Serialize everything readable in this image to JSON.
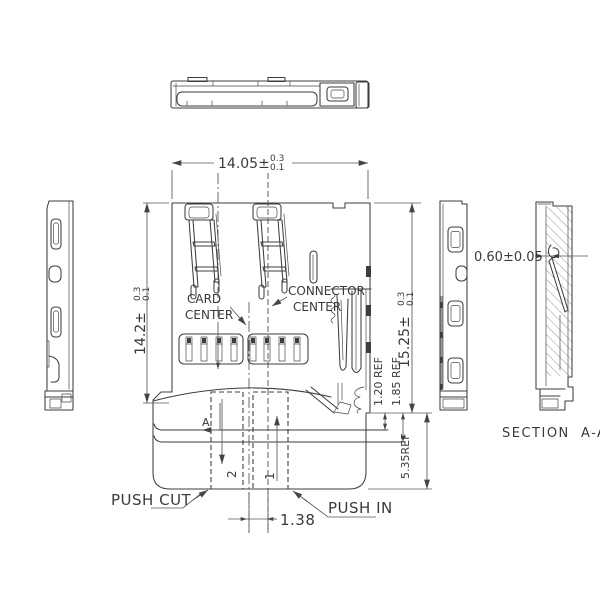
{
  "colors": {
    "background": "#ffffff",
    "object_line": "#3d3d3d",
    "dimension_line": "#565656",
    "text": "#3a3a3a",
    "shading": "#9b9b9b"
  },
  "dimensions": {
    "top_width": {
      "main": "14.05±",
      "tol_top": "0.3",
      "tol_bot": "0.1"
    },
    "left_height": {
      "main": "14.2±",
      "tol_top": "0.3",
      "tol_bot": "0.1"
    },
    "right_height": {
      "main": "15.25±",
      "tol_top": "0.3",
      "tol_bot": "0.1"
    },
    "shell_thickness": "0.60±0.05",
    "ref_1_20": "1.20 REF",
    "ref_1_85": "1.85 REF",
    "ref_5_35": "5.35REF",
    "center_offset": "1.38"
  },
  "labels": {
    "card_center": [
      "CARD",
      "CENTER"
    ],
    "connector_center": [
      "CONNECTOR",
      "CENTER"
    ],
    "push_cut": "PUSH CUT",
    "push_in": "PUSH IN",
    "section_title": "SECTION  A-A",
    "section_cut": "A",
    "step_1": "1",
    "step_2": "2"
  }
}
